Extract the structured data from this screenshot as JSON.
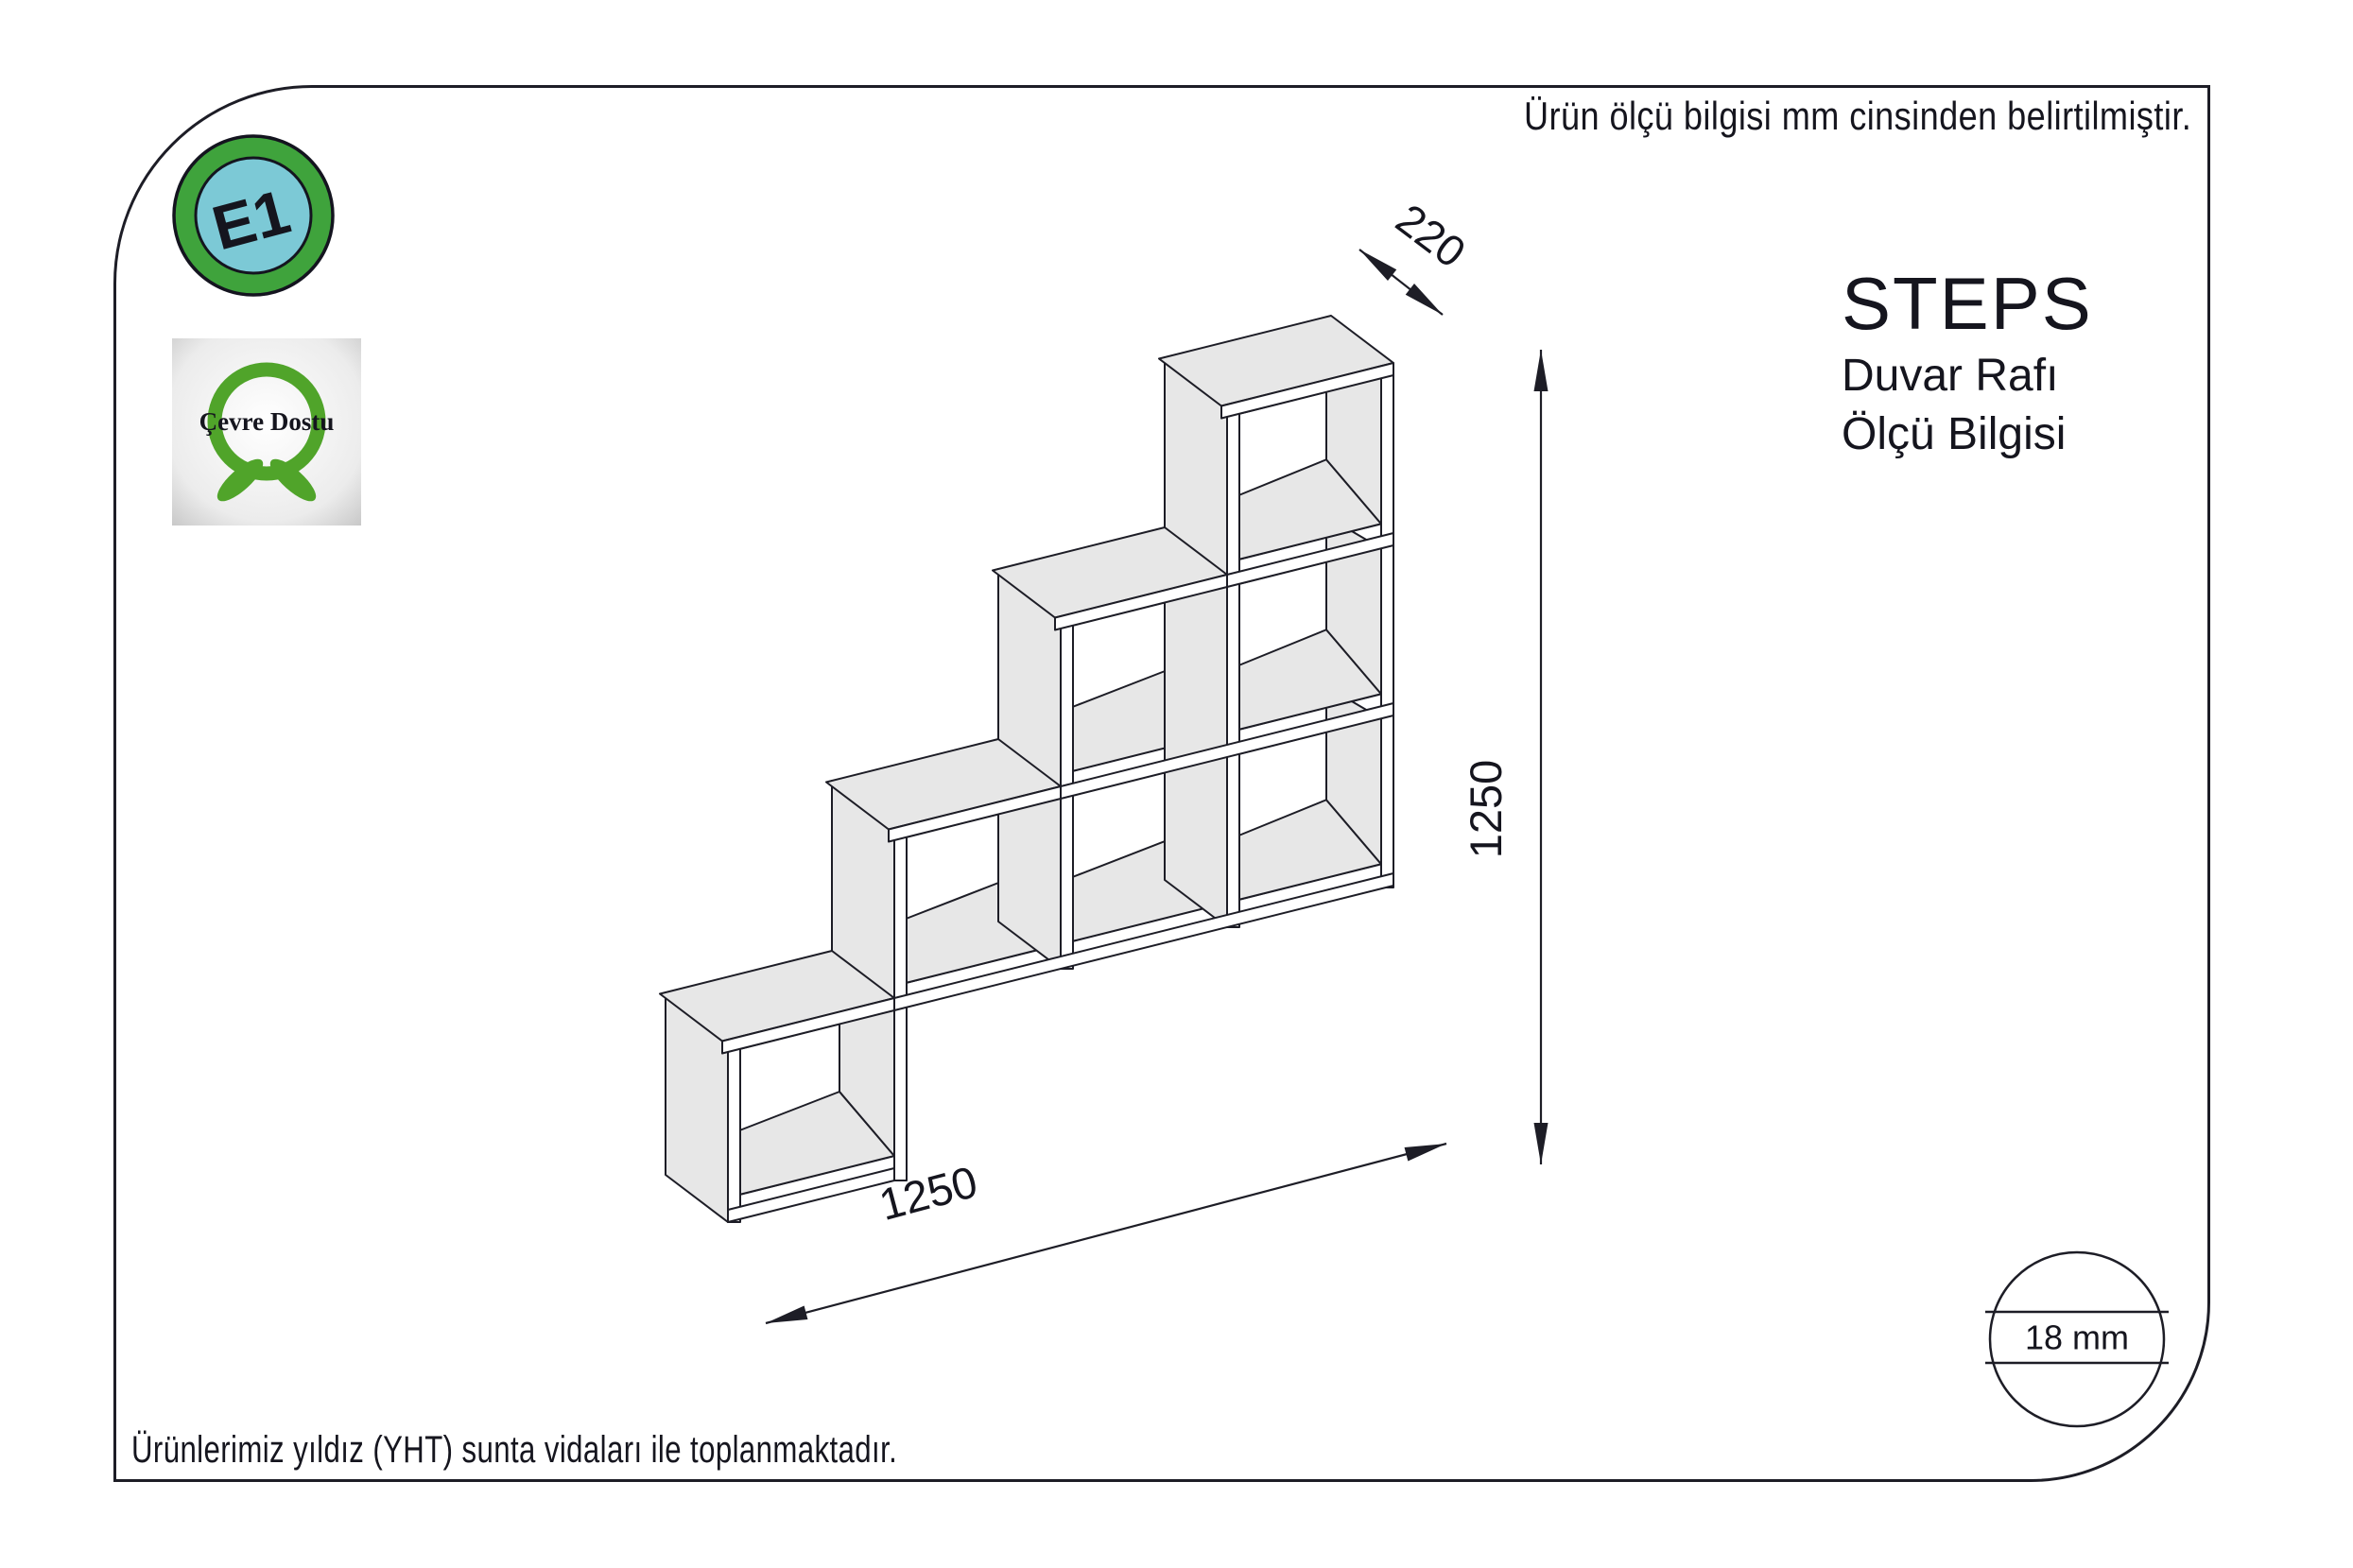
{
  "notes": {
    "top": "Ürün ölçü bilgisi mm cinsinden belirtilmiştir.",
    "bottom": "Ürünlerimiz yıldız (YHT) sunta vidaları ile toplanmaktadır."
  },
  "title": {
    "product": "STEPS",
    "line2": "Duvar Rafı",
    "line3": "Ölçü Bilgisi"
  },
  "badges": {
    "e1": "E1",
    "eco": "Çevre Dostu"
  },
  "dims": {
    "depth": "220",
    "height": "1250",
    "width": "1250",
    "thickness": "18 mm"
  },
  "colors": {
    "line": "#1d1d26",
    "text": "#15151e",
    "shelf_fill": "#e7e7e7",
    "white": "#ffffff",
    "e1_outer_green": "#3fa33c",
    "e1_inner_teal": "#7cc9d6",
    "eco_green": "#50a42a"
  }
}
